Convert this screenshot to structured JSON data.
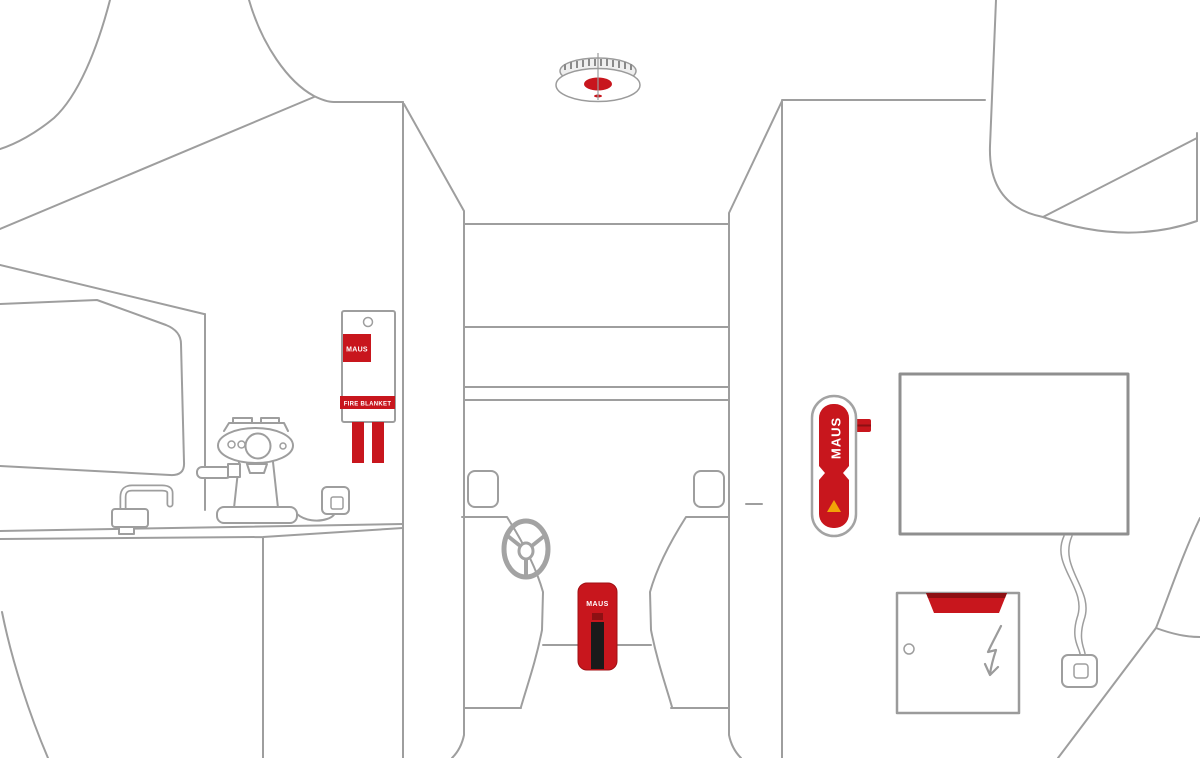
{
  "illustration": {
    "title": "Campervan interior fire safety illustration",
    "colors": {
      "line": "#9e9e9e",
      "brand_red": "#c8161d",
      "dark_red": "#8d1013",
      "stripe_black": "#1a1a1a",
      "warning_yellow": "#f2a307"
    },
    "products": {
      "smoke_detector": {
        "name": "ceiling smoke detector"
      },
      "fire_blanket": {
        "brand": "MAUS",
        "label": "FIRE BLANKET"
      },
      "cab_extinguisher": {
        "brand": "MAUS"
      },
      "wall_extinguisher": {
        "brand": "MAUS"
      },
      "panel_suppressor": {
        "name": "electrical panel fire suppressor"
      }
    }
  }
}
